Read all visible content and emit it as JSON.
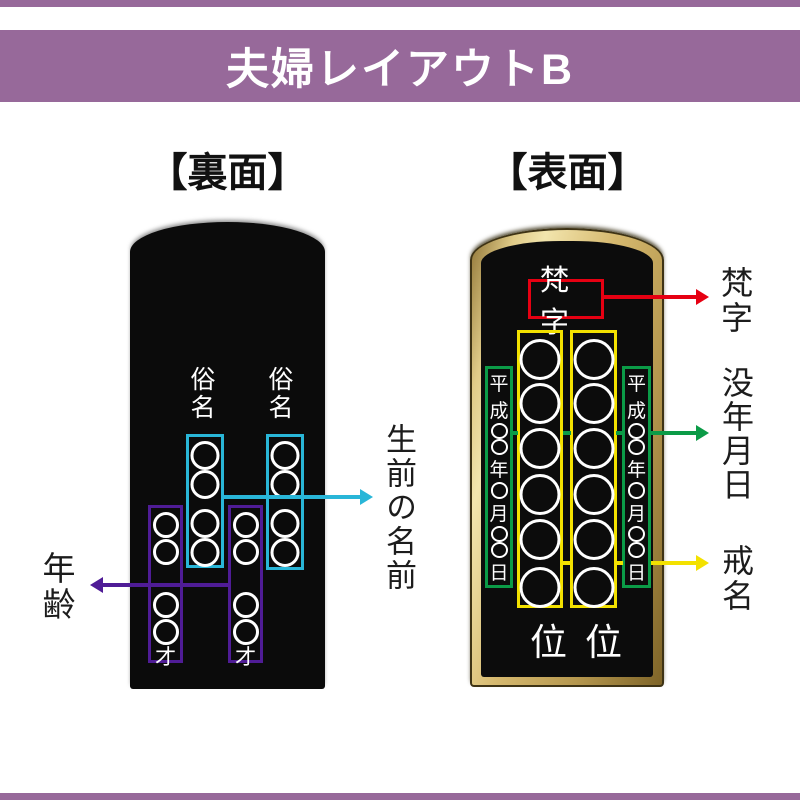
{
  "banner": {
    "title": "夫婦レイアウトB"
  },
  "colors": {
    "banner": "#97699a",
    "name_highlight": "#29b6d8",
    "age_highlight": "#4f1c96",
    "bonji_highlight": "#e60012",
    "kaimyo_highlight": "#f3e100",
    "date_highlight": "#0b9b47",
    "tablet_gold": "#cdb06a",
    "tablet_black": "#0b0b0b"
  },
  "back": {
    "heading": "【裏面】",
    "column_label_left": "俗名",
    "column_label_right": "俗名",
    "age_suffix": "才",
    "name_circles_per_column": 4,
    "age_circles_per_column": 4,
    "annotations": {
      "name": {
        "label": "生前の名前",
        "color": "#29b6d8"
      },
      "age": {
        "label": "年齢",
        "color": "#4f1c96"
      }
    }
  },
  "front": {
    "heading": "【表面】",
    "bonji_box_text": "梵字",
    "rank_char": "位",
    "kaimyo_circles_per_column": 6,
    "date_text": "平成○○年○月○○日",
    "date_chars": {
      "era1": "平",
      "era2": "成",
      "year": "年",
      "month": "月",
      "day": "日"
    },
    "annotations": {
      "bonji": {
        "label": "梵字",
        "color": "#e60012"
      },
      "date": {
        "label": "没年月日",
        "color": "#0b9b47"
      },
      "kaimyo": {
        "label": "戒名",
        "color": "#f3e100"
      }
    }
  }
}
